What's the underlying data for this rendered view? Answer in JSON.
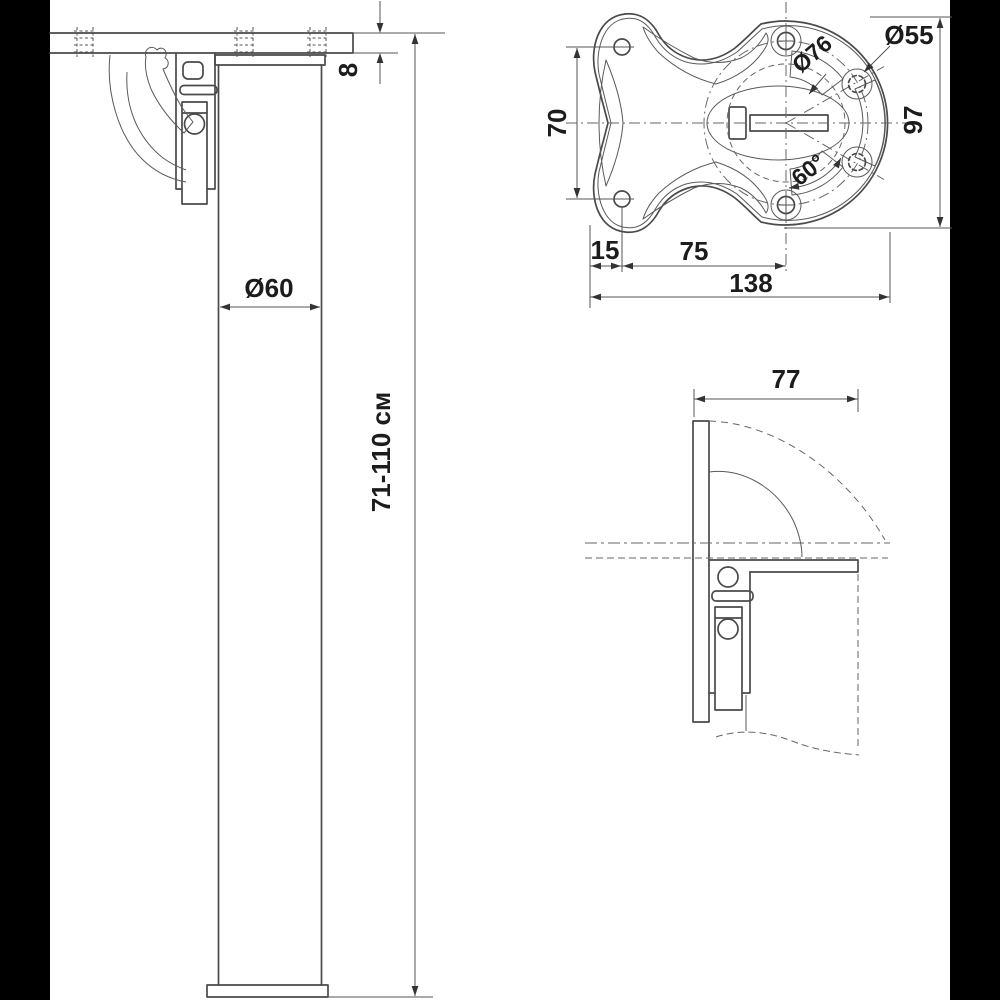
{
  "drawing": {
    "type": "technical-drawing",
    "subject": "folding-table-leg",
    "colors": {
      "background": "#ffffff",
      "letterbox": "#000000",
      "line": "#4a4a4a",
      "text": "#1c1c1c"
    },
    "views": {
      "leg_side": {
        "dims": {
          "plate_thickness": "8",
          "tube_diameter": "Ø60",
          "height_range": "71-110 см"
        }
      },
      "plate_top": {
        "dims": {
          "screw_hole_spacing": "70",
          "flange_width": "97",
          "hole_circle_diameter": "Ø76",
          "center_circle_diameter": "Ø55",
          "hole_angle": "60°",
          "edge_to_screw_hole": "15",
          "screw_hole_to_center": "75",
          "plate_length": "138"
        }
      },
      "folded_side": {
        "dims": {
          "fold_clearance": "77"
        }
      }
    }
  }
}
